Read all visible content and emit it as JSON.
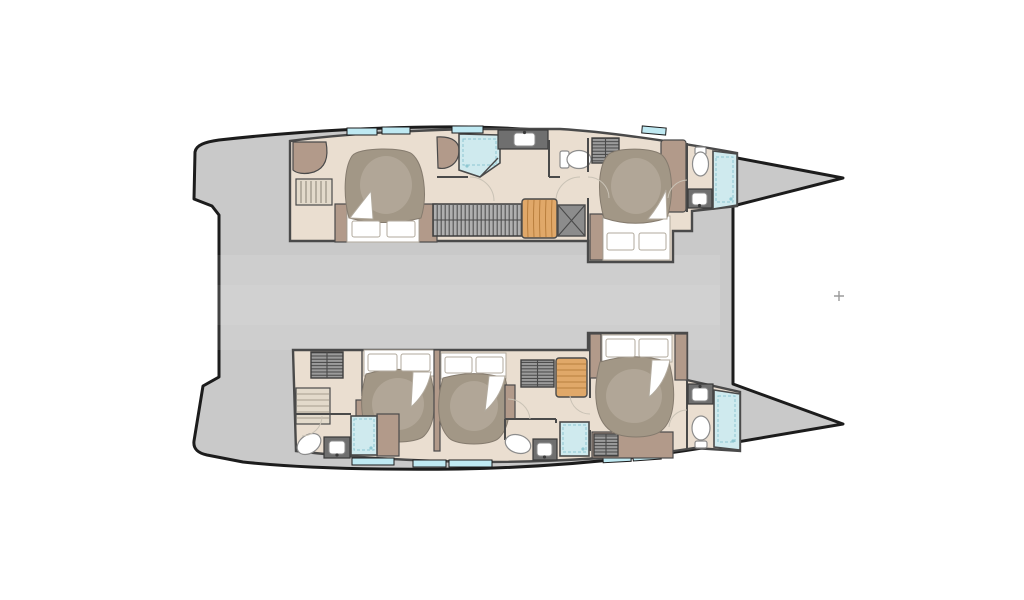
{
  "meta": {
    "label": "Catamaran yacht deck floor plan, five cabin layout, bows pointing right",
    "diagram_type": "boat-floorplan",
    "vessel": "sailing catamaran",
    "view": "top-down",
    "bow_direction": "right"
  },
  "palette": {
    "background": "#ffffff",
    "hull_outline": "#1c1c1c",
    "deck": "#c9c9c9",
    "deck_sheen": "#ffffff",
    "wall": "#4a4a4a",
    "floor": "#eaded0",
    "cabinetry": "#b29a8a",
    "duvet": "#a29786",
    "duvet_highlight": "#b6ab9c",
    "duvet_edge": "#857b6e",
    "linen": "#ffffff",
    "linen_edge": "#b2aa9d",
    "fixture_edge": "#8c8c8c",
    "shower": "#cfeaee",
    "shower_detail": "#8ec7d1",
    "window": "#bfe9f2",
    "counter": "#6f6f6f",
    "counter_edge": "#3a3a3a",
    "stair_wood": "#e0a869",
    "stair_wood_line": "#b97f3e",
    "step_light": "#e3dacb",
    "step_line": "#a79e8f",
    "tech_gray": "#8c8c8c",
    "slat_gray": "#b0b0b0",
    "slat_line": "#515151",
    "louver_gray": "#9b9b9b",
    "louver_line": "#3e3e3e",
    "door_arc": "#c9c2b5",
    "shelf_line": "#8a8175",
    "mark": "#9b9b9b"
  },
  "structure": {
    "hull_count": 2,
    "cabin_count": 5,
    "bathroom_count": 5,
    "double_bed_count": 5,
    "shower_count": 5,
    "toilet_count": 5,
    "washbasin_count": 6,
    "hulls": [
      {
        "name": "upper hull",
        "rooms": [
          {
            "name": "aft cabin",
            "furniture": [
              "double-bed",
              "wardrobe-shelves",
              "corner-cabinet"
            ]
          },
          {
            "name": "aft ensuite bathroom",
            "furniture": [
              "shower",
              "vanity",
              "washbasin",
              "toilet"
            ]
          },
          {
            "name": "companionway",
            "furniture": [
              "slatted-bench",
              "wood-stairs",
              "technical-locker"
            ]
          },
          {
            "name": "forward cabin",
            "furniture": [
              "double-bed",
              "louvered-wardrobe",
              "cabinet-column"
            ]
          },
          {
            "name": "forward ensuite bathroom",
            "furniture": [
              "toilet",
              "washbasin",
              "shower"
            ]
          }
        ]
      },
      {
        "name": "lower hull",
        "rooms": [
          {
            "name": "aft cabin",
            "furniture": [
              "double-bed",
              "louvered-wardrobe",
              "access-steps"
            ]
          },
          {
            "name": "aft ensuite bathroom",
            "furniture": [
              "toilet",
              "washbasin",
              "shower"
            ]
          },
          {
            "name": "middle cabin",
            "furniture": [
              "double-bed",
              "louvered-wardrobe"
            ]
          },
          {
            "name": "middle ensuite bathroom",
            "furniture": [
              "toilet",
              "washbasin",
              "shower"
            ]
          },
          {
            "name": "companionway",
            "furniture": [
              "wood-stairs"
            ]
          },
          {
            "name": "forward cabin",
            "furniture": [
              "double-bed",
              "cabinet-columns",
              "vent-locker"
            ]
          },
          {
            "name": "forward ensuite bathroom",
            "furniture": [
              "washbasin",
              "toilet",
              "shower"
            ]
          }
        ]
      }
    ],
    "deck_features": [
      "stern-platforms",
      "foredeck-cutout-between-bows",
      "hull-windows",
      "deck-skylights",
      "center-deck-mark"
    ]
  }
}
